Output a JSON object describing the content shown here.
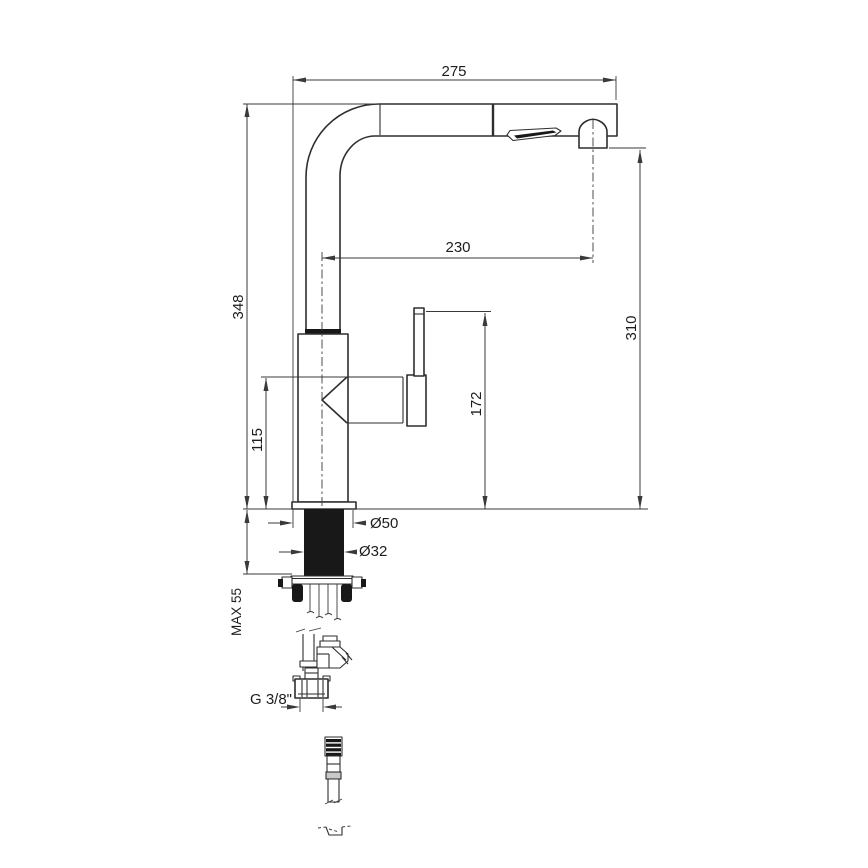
{
  "drawing": {
    "type": "technical-dimension-drawing",
    "subject": "kitchen sink mixer tap with pull-out spray head, side elevation with below-deck mounting parts",
    "units": "mm",
    "dimensions": {
      "reach_overall": "275",
      "reach_to_nozzle_axis": "230",
      "height_overall": "348",
      "height_to_nozzle_outlet": "310",
      "height_to_lever_top": "172",
      "height_to_handle_axis": "115",
      "max_deck_thickness": "MAX 55",
      "base_diameter": "Ø50",
      "shank_diameter": "Ø32",
      "supply_thread": "G 3/8\""
    }
  }
}
